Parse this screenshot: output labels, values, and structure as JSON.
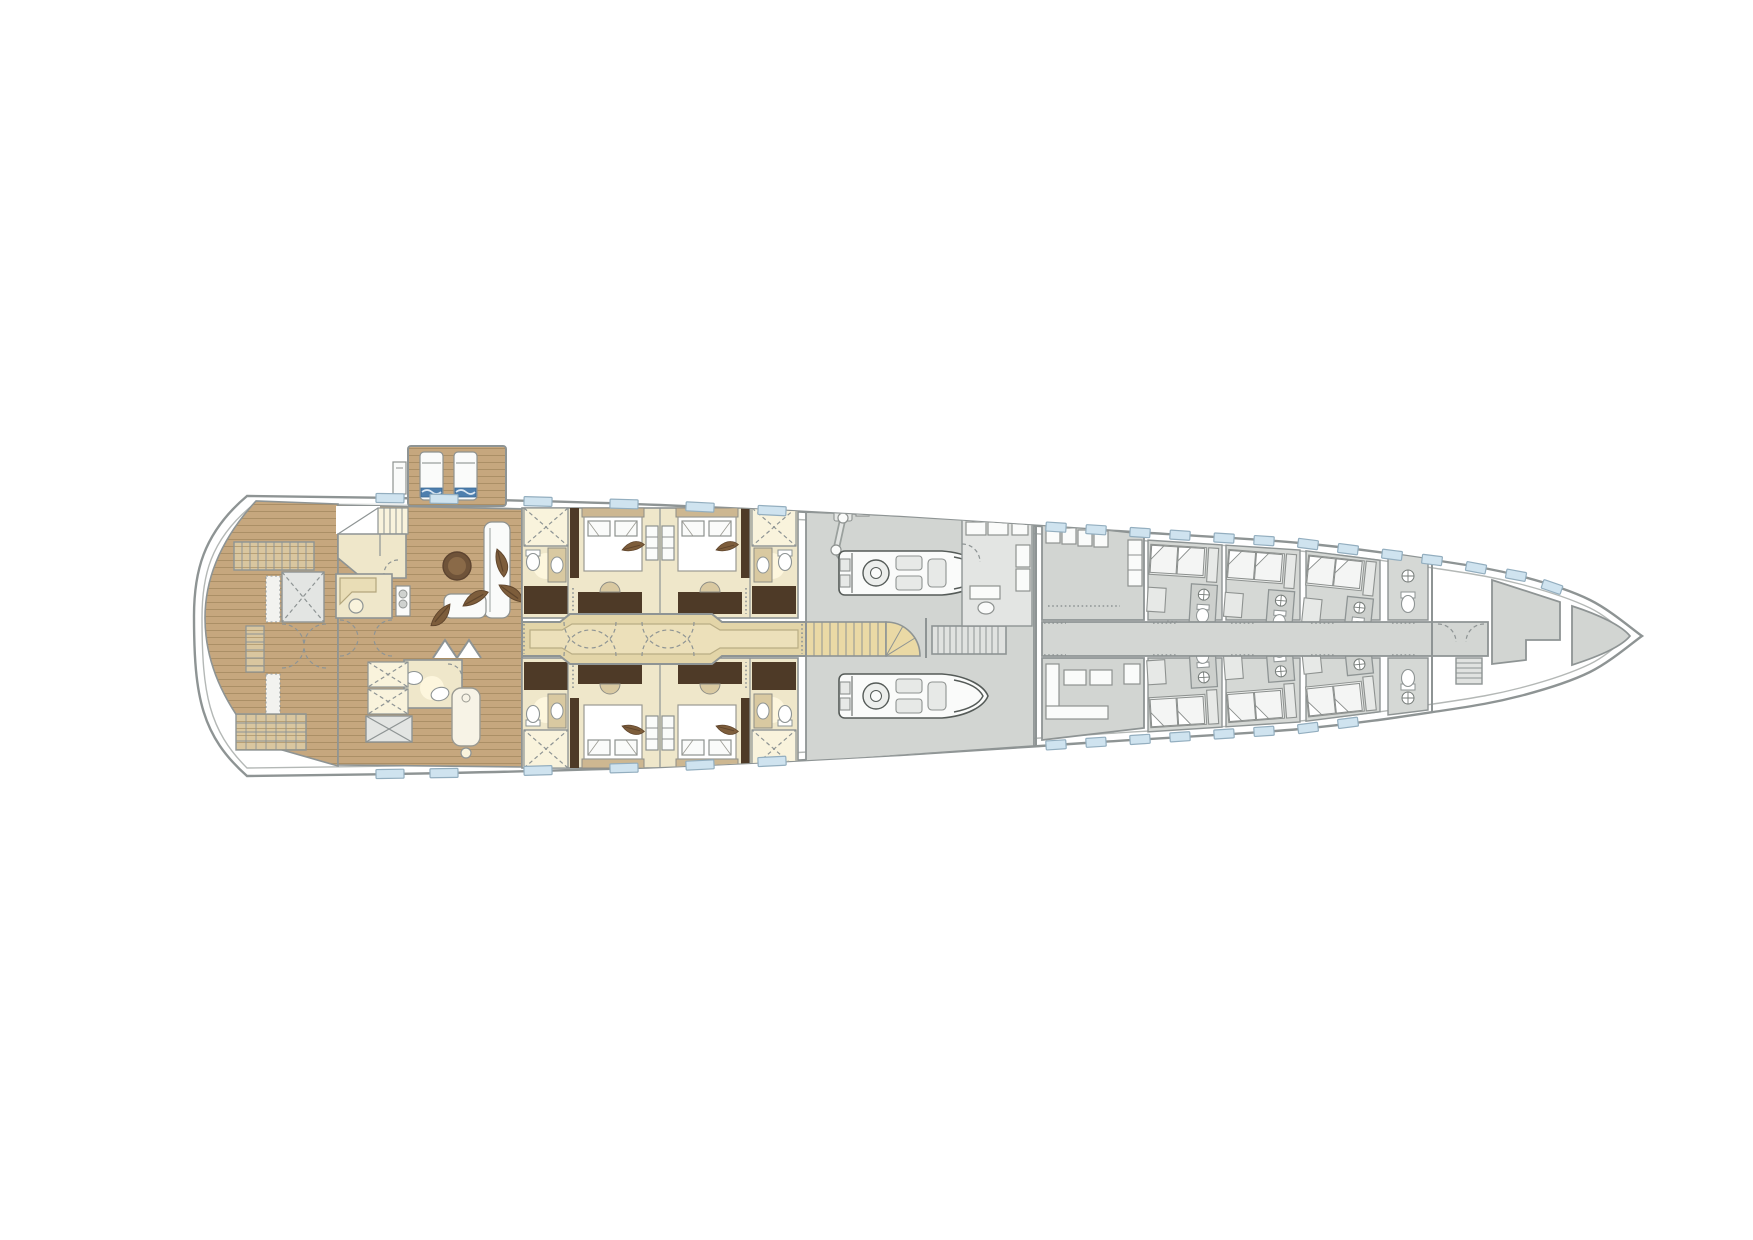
{
  "meta": {
    "title": "Motor yacht lower deck — general arrangement floor plan",
    "drawing_type": "floor-plan",
    "visible_text": "none"
  },
  "palette": {
    "hull_stroke": "#8e9494",
    "hull_inner_line": "#b4b8b6",
    "side_deck": "#e9ebea",
    "teak_wood": "#c6a77e",
    "teak_line": "#ab8f66",
    "stair_wood": "#d9c69f",
    "cabin_cream": "#efe7ca",
    "bathroom_cream": "#f9f3dc",
    "joinery_dark_brown": "#4e3a27",
    "bed_frame_tan": "#cdb791",
    "corridor_tan": "#e3d5a8",
    "corridor_inner_tan": "#ece0ba",
    "crew_gray": "#d2d5d2",
    "room_gray": "#e3e5e3",
    "stair_tan": "#ead9a5",
    "window_blue": "#cfe3ef",
    "coffee_table_brown": "#6f5339",
    "towel_blue": "#4e7fae"
  },
  "hull": {
    "top_edge": [
      [
        247,
        496
      ],
      [
        450,
        499
      ],
      [
        660,
        505
      ],
      [
        900,
        517
      ],
      [
        1100,
        530
      ],
      [
        1300,
        543
      ],
      [
        1440,
        561
      ],
      [
        1520,
        576
      ],
      [
        1590,
        600
      ],
      [
        1642,
        636
      ]
    ],
    "bottom_edge": [
      [
        247,
        776
      ],
      [
        450,
        773
      ],
      [
        660,
        767
      ],
      [
        900,
        755
      ],
      [
        1100,
        742
      ],
      [
        1300,
        729
      ],
      [
        1440,
        711
      ],
      [
        1520,
        696
      ],
      [
        1590,
        672
      ],
      [
        1642,
        636
      ]
    ],
    "stern_x": 194,
    "bow_tip": [
      1642,
      636
    ],
    "centerline_y": 636
  },
  "windows": {
    "guest_width": 28,
    "crew_width": 20,
    "top_x": [
      390,
      444,
      538,
      624,
      700,
      772,
      1056,
      1096,
      1140,
      1180,
      1224,
      1264,
      1308,
      1348,
      1392,
      1432,
      1476,
      1516,
      1552
    ],
    "bottom_x": [
      390,
      444,
      538,
      624,
      700,
      772,
      1056,
      1096,
      1140,
      1180,
      1224,
      1264,
      1308,
      1348
    ]
  },
  "sun_platform": {
    "loungers": [
      [
        420,
        452
      ],
      [
        454,
        452
      ]
    ],
    "count": 2
  },
  "tender_garage": {
    "tenders": [
      [
        838,
        551
      ],
      [
        838,
        674
      ]
    ],
    "crane_count": 1,
    "staircases": 2
  },
  "crew_cabins": {
    "top": [
      [
        1148,
        540,
        3.5
      ],
      [
        1226,
        546,
        4.5
      ],
      [
        1306,
        551,
        6
      ]
    ],
    "bottom": [
      [
        1148,
        732,
        3.5
      ],
      [
        1226,
        727,
        4.5
      ],
      [
        1306,
        722,
        6
      ]
    ],
    "count": 6
  },
  "feathers": [
    [
      497,
      549,
      115
    ],
    [
      499,
      585,
      75
    ],
    [
      463,
      606,
      10
    ],
    [
      450,
      604,
      170
    ]
  ],
  "areas": {
    "stern": {
      "name": "beach club deck",
      "features": [
        "teak deck",
        "stairs",
        "lift platform",
        "boarding ladders",
        "grating platform"
      ]
    },
    "sun_platform": {
      "name": "stern sun platform",
      "features": [
        "2 sun loungers",
        "deck box"
      ]
    },
    "owner": {
      "name": "lounge and spa",
      "features": [
        "L-sofa",
        "round coffee table",
        "desk",
        "day bathroom",
        "massage table",
        "shower shafts",
        "folding doors"
      ]
    },
    "guest": {
      "name": "guest cabins",
      "cabins": 4,
      "ensuite_bathrooms": 4,
      "features": [
        "double beds",
        "desks",
        "shower rooms"
      ]
    },
    "corridor": {
      "name": "guest lobby corridor"
    },
    "garage": {
      "name": "tender garage",
      "features": [
        "2 tenders",
        "deck crane",
        "guest staircase",
        "crew staircase",
        "office"
      ]
    },
    "crew": {
      "name": "crew quarters",
      "features": [
        "crew mess",
        "crew lounge",
        "6 bunk cabins",
        "2 WC cells",
        "corridor"
      ]
    },
    "bow": {
      "name": "forepeak",
      "features": [
        "store rooms",
        "stair down",
        "vestibule"
      ]
    }
  }
}
